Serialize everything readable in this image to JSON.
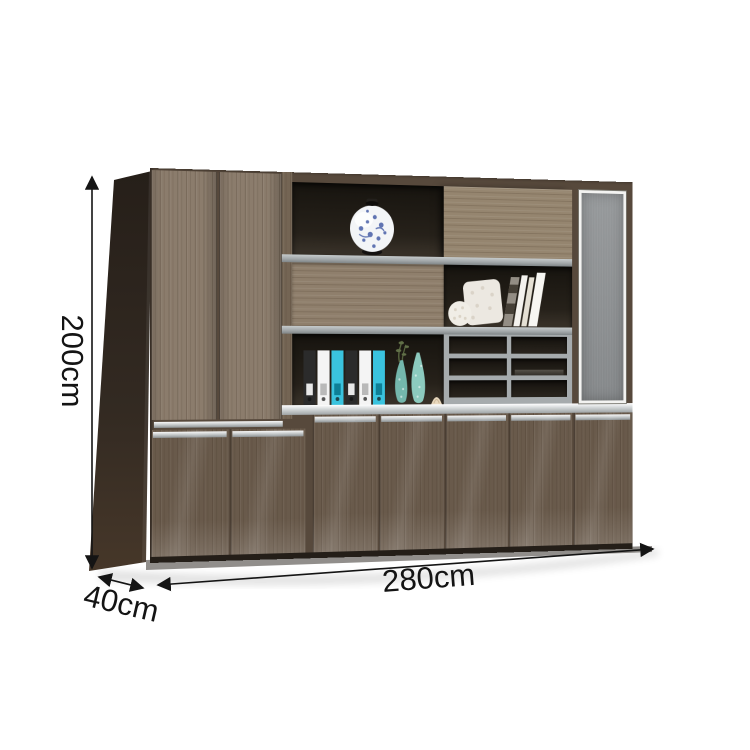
{
  "dimension_labels": {
    "height": "200cm",
    "width": "280cm",
    "depth": "40cm"
  },
  "annotations": {
    "height_arrow": "vertical double arrow, left of cabinet",
    "width_arrow": "horizontal double arrow along cabinet bottom",
    "depth_arrow": "diagonal double arrow at bottom-left corner"
  },
  "colors": {
    "background": "#ffffff",
    "wood_upper_doors": "#8b7c6c",
    "wood_lower_doors": "#695a4b",
    "wood_side_panel": "#332a23",
    "wood_sliding_panel": "#95856f",
    "frame_wood": "#746554",
    "shelf_gray": "#a3a8aa",
    "compartment_dark": "#221e18",
    "glass_gray": "#8f9395",
    "glass_frame_white": "#f3f3f1",
    "handle_aluminum": "#c4c8c9",
    "annotation_black": "#141414",
    "binder_cyan": "#3ac3de",
    "porcelain_blue": "#3c55a2",
    "vase_teal": "#74b7ac"
  },
  "decor_items": {
    "porcelain_vase": "blue-and-white round porcelain vase",
    "binders": [
      "black",
      "white",
      "cyan",
      "black",
      "white",
      "cyan"
    ],
    "teal_vases": "two speckled teal teardrop vases with plant sprig",
    "seashell": "small cream seashell",
    "books_shelf": "white lace pillow, lace ball and leaning books",
    "pigeonholes": "2x3 open gray-framed compartments with thin dark book",
    "glass_door": "tall frosted glass door with white aluminum frame"
  }
}
